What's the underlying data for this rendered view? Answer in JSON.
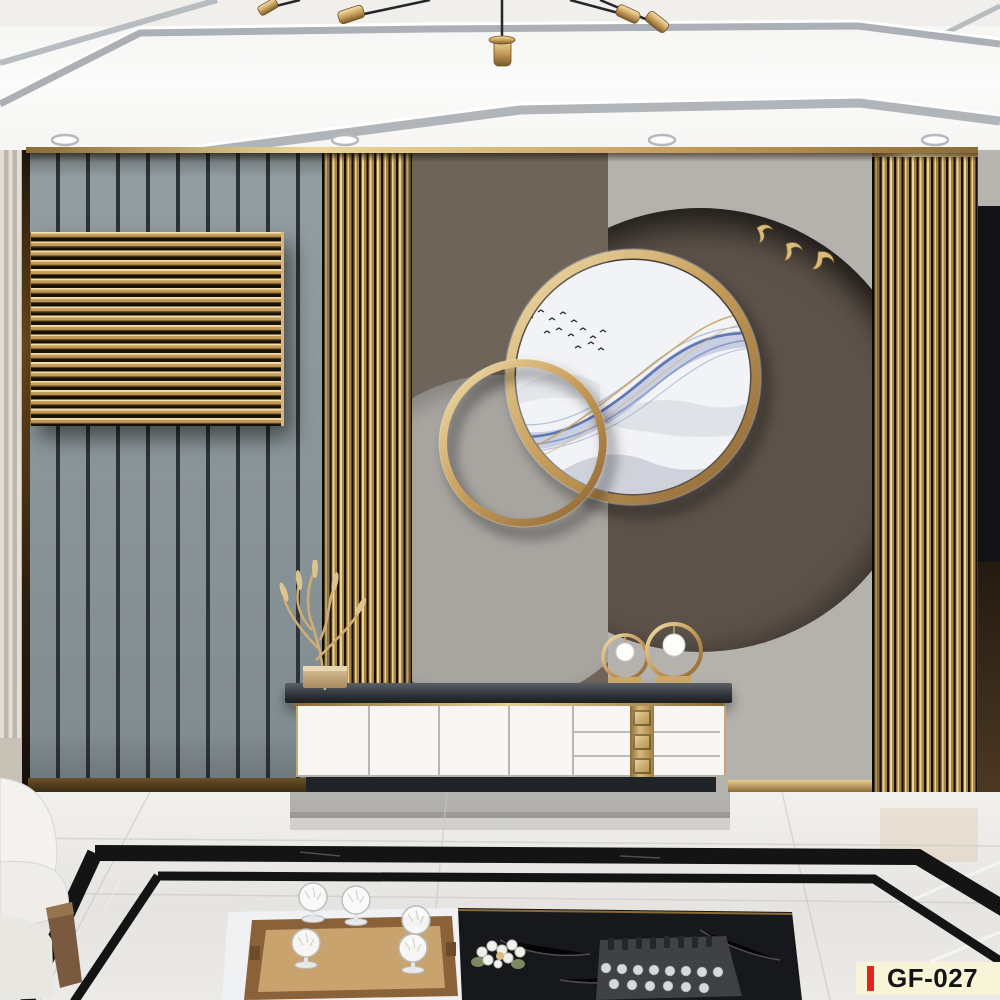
{
  "product_label": {
    "code": "GF-027"
  },
  "palette": {
    "gold": "#c59a58",
    "gold_light": "#ecd49a",
    "gold_deep": "#8a6a35",
    "slat_gap": "#171007",
    "ceiling_white": "#fbfbfa",
    "trim_silver": "#aab0b5",
    "wall_gray": "#8b969a",
    "wall_groove": "#2e3335",
    "mural_brown": "#6e6459",
    "mural_light": "#b5b1ac",
    "circle_light": "#a8a5a0",
    "circle_dark": "#5c5249",
    "art_bg": "#f2f3f6",
    "art_blue": "#5d73b2",
    "art_mountain": "#b7bdc8",
    "cabinet_top": "#393d43",
    "cabinet_white": "#f7f6f4",
    "plinth_dark": "#202328",
    "floor_white": "#eae8e4",
    "border_black": "#141414",
    "marble_black": "#17181b",
    "wood_tray": "#a87e4e",
    "sofa_white": "#f1f0ec",
    "leg_brown": "#6e5238",
    "label_bg": "#f8f4d8",
    "label_red": "#e3241f",
    "label_text": "#141414"
  },
  "scene": {
    "room": "living-room with 3D gold-slat TV feature wall",
    "ceiling": {
      "downlights": 4,
      "chandelier": "gold-sputnik-chandelier"
    },
    "wall": {
      "left_panel": "gray-vertical-slat-wall",
      "gold_louver_panel": "horizontal-gold-slat-panel",
      "gold_slat_columns": 2,
      "mural": {
        "gold_rings": 2,
        "artwork": "blue-ink-landscape-with-bird-flock",
        "gold_birds": 3
      }
    },
    "cabinet": {
      "doors": 4,
      "drawers": 3,
      "decor": [
        "gold-branch-sculpture",
        "ring-ornament-small",
        "ring-ornament-large"
      ]
    },
    "floor": {
      "material": "white-marble",
      "border": "black-marble-inlay"
    },
    "coffee_table": {
      "items": [
        "wooden-tray",
        "crystal-goblets",
        "flower-cluster",
        "chess-set"
      ]
    }
  }
}
